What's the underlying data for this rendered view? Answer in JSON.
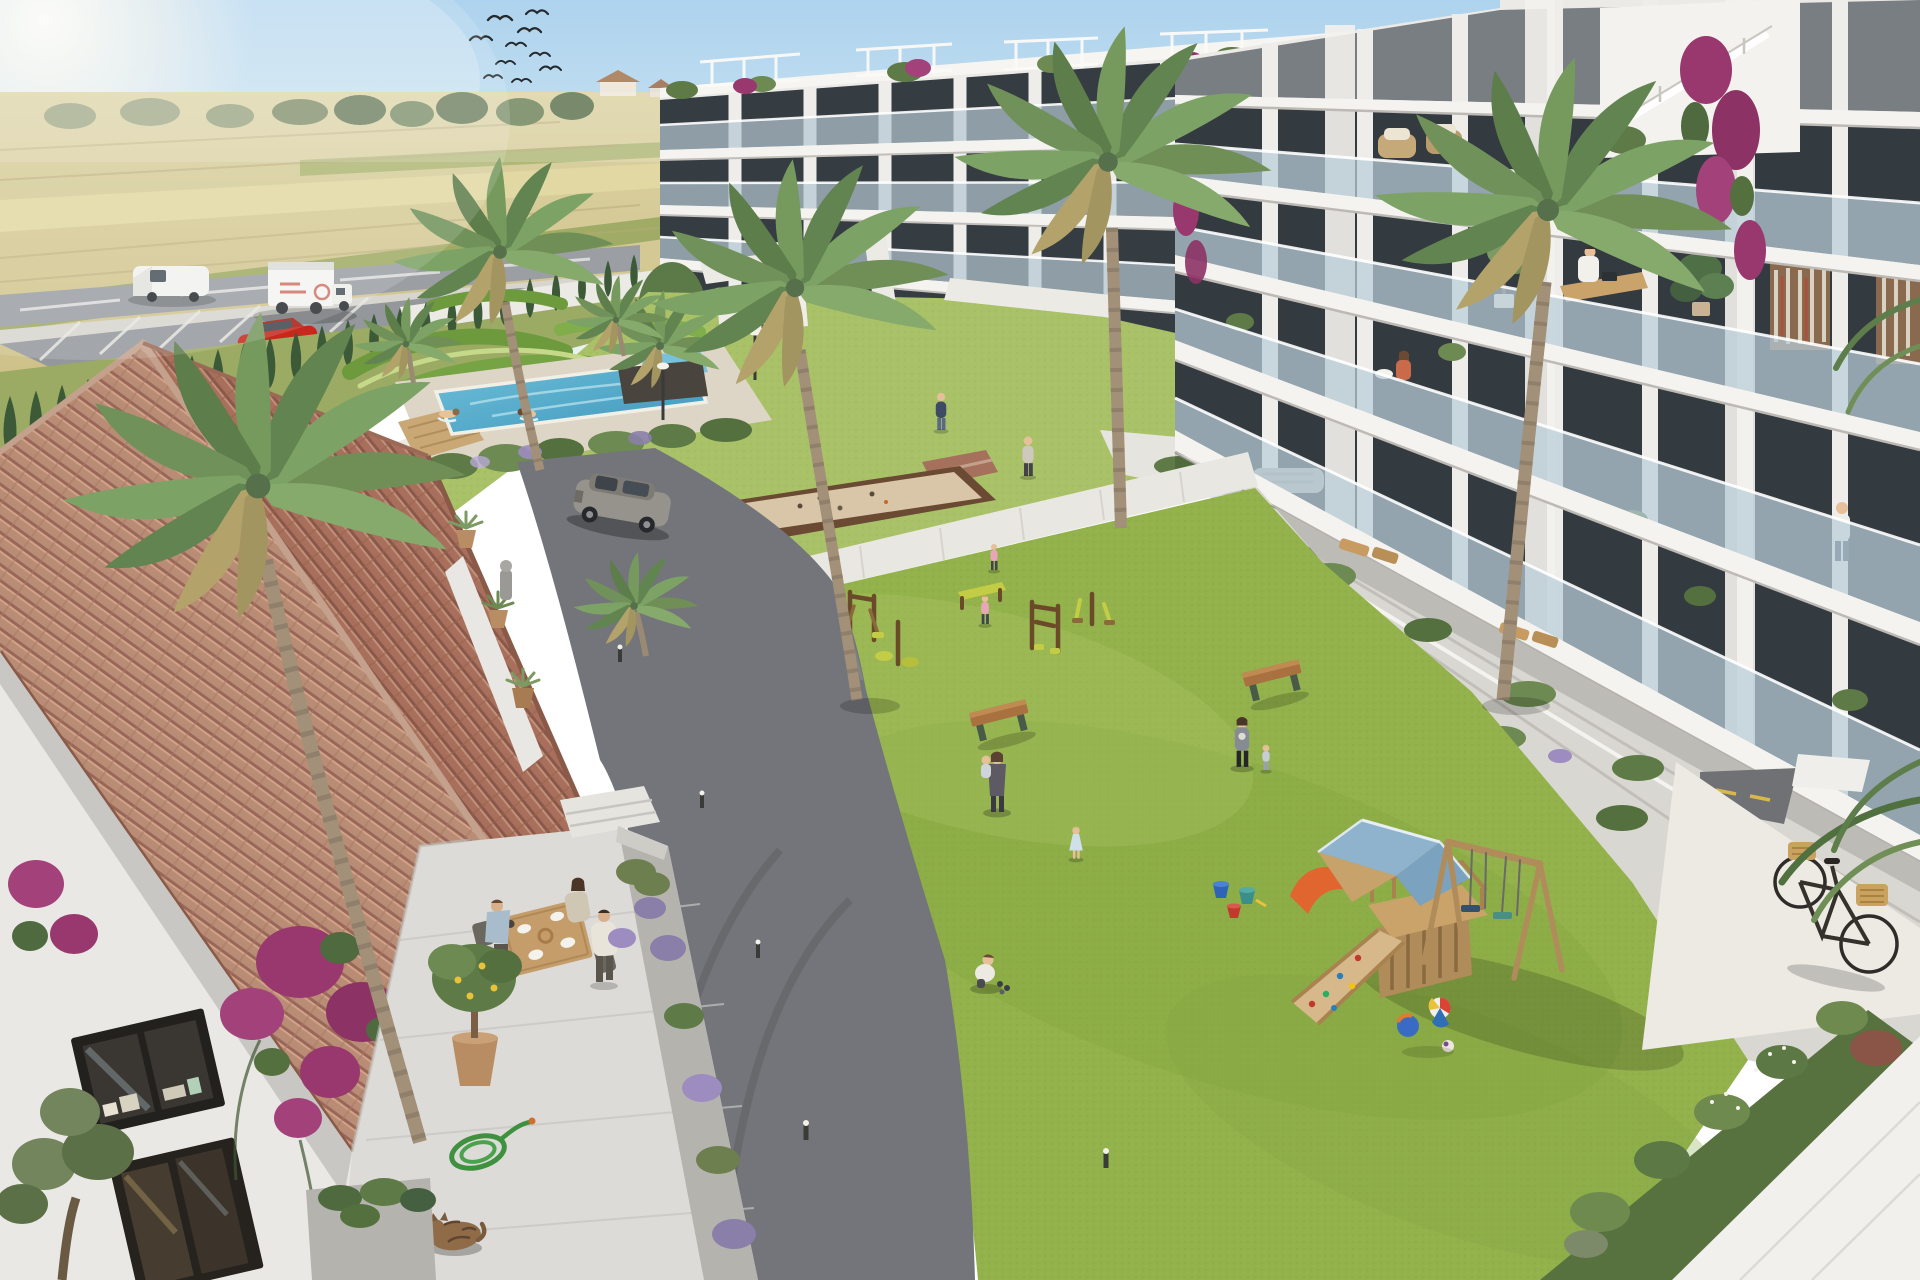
{
  "meta": {
    "title": "Aerial render of a Mediterranean new-build apartment complex with landscaped courtyard",
    "description": "Photorealistic architectural visualization seen from above: two white modern apartment blocks with glass balconies surround a green courtyard containing a lap pool, parterre garden, petanque court, outdoor gym and a wooden playground with blue roof, slide and swings. In the foreground a terracotta tiled-roof house has a breakfast terrace with three people, a potted lemon tree, bougainvillea, a garden hose and a sleeping tabby cat. Behind the complex lie dry farm fields, a road with a white van and a box truck, a parked red car and a cypress hedge. Palm trees, residents, a gray SUV on the driveway and a bicycle with wicker baskets complete the scene."
  },
  "palette": {
    "sky_top": "#b5d7ee",
    "sky_horizon": "#e6f1f1",
    "sun_glow": "#fff8ec",
    "field_gold": "#d5c891",
    "field_green": "#9aa95f",
    "treeline_green": "#5f7350",
    "road_asphalt": "#9b9fa3",
    "driveway_asphalt": "#73757a",
    "path_light": "#e9e7e1",
    "lawn_main": "#93b24c",
    "lawn_ornamental": "#a9c268",
    "parterre_dark": "#6e9a3e",
    "pool_water": "#56aecd",
    "deck_travertine": "#ddd6c6",
    "facade_white": "#eceae6",
    "slab_white": "#f4f3ef",
    "window_dark": "#343b40",
    "glass_blue": "#b9cdd8",
    "roof_tile_dark": "#a8705c",
    "roof_tile_light": "#b98d75",
    "ridge_cap": "#c4a18c",
    "house_wall": "#eae8e4",
    "terrace_marble": "#dcdbd7",
    "wood_play": "#caa36b",
    "play_roof_blue": "#8fb3cd",
    "slide_orange": "#e0652f",
    "bench_wood": "#a9713f",
    "gym_wood": "#6b4a2a",
    "gym_accent": "#c3cc45",
    "cypress_green": "#3d5a38",
    "palm_green": "#6f8f57",
    "bougainvillea": "#99386e",
    "lavender": "#8a7fa8",
    "suv_gray": "#96938c",
    "car_red": "#c8271b",
    "cat_brown": "#8f6b48",
    "hose_green": "#3f9140",
    "bike_frame": "#35312c",
    "basket_wicker": "#c9a25f"
  },
  "scene": {
    "sky": {
      "label": "clear summer sky with sun glare",
      "bird_flock_count": 10
    },
    "background": {
      "label": "dry farmland with crop rows, distant farmhouses and tree line",
      "road_vehicles": [
        "white van",
        "white box truck"
      ],
      "parked_car": "red car in parking bay",
      "hedge": "row of cypress trees along white boundary fence"
    },
    "buildings": {
      "left_block": {
        "label": "white 4-storey apartment block with glass balconies and rooftop pergolas",
        "floors": 4
      },
      "right_block": {
        "label": "white 5-storey apartment block with stepped balconies, residents and plants",
        "floors": 5,
        "balcony_details": [
          "man working at desk",
          "bookshelf walls",
          "monstera plant",
          "seated woman",
          "rooftop wicker chairs",
          "cascading bougainvillea"
        ]
      }
    },
    "amenities": {
      "pool": {
        "label": "lap pool with two swimmers and wooden deck"
      },
      "parterre": {
        "label": "ornamental sculpted lawn garden"
      },
      "petanque_court": {
        "label": "sand petanque court with wooden border"
      },
      "outdoor_gym": {
        "label": "five wooden outdoor fitness machines",
        "machines": 5
      },
      "playground": {
        "label": "wooden play tower with blue gable roof, climbing ramp, orange slide, double swing",
        "toys": [
          "beach ball",
          "blue ball",
          "small ball",
          "blue bucket",
          "teal bucket",
          "red bucket"
        ]
      },
      "benches": 2
    },
    "people": {
      "terrace_breakfast": 3,
      "swimmers": 2,
      "lawn_walkers_and_kids": 8,
      "balcony_residents": 3,
      "courtyard_walkers": 3
    },
    "foreground_house": {
      "label": "Spanish house with terracotta barrel-tile hipped roof and marble breakfast terrace",
      "details": [
        "potted lemon tree",
        "bougainvillea in bloom",
        "coiled garden hose",
        "sleeping tabby cat",
        "window with books on sill",
        "lavender planters",
        "agave pots"
      ]
    },
    "vehicles": {
      "suv": "gray SUV driving on the curved asphalt driveway"
    },
    "bicycle": {
      "label": "black city bike with two wicker baskets leaning by the white path"
    }
  }
}
